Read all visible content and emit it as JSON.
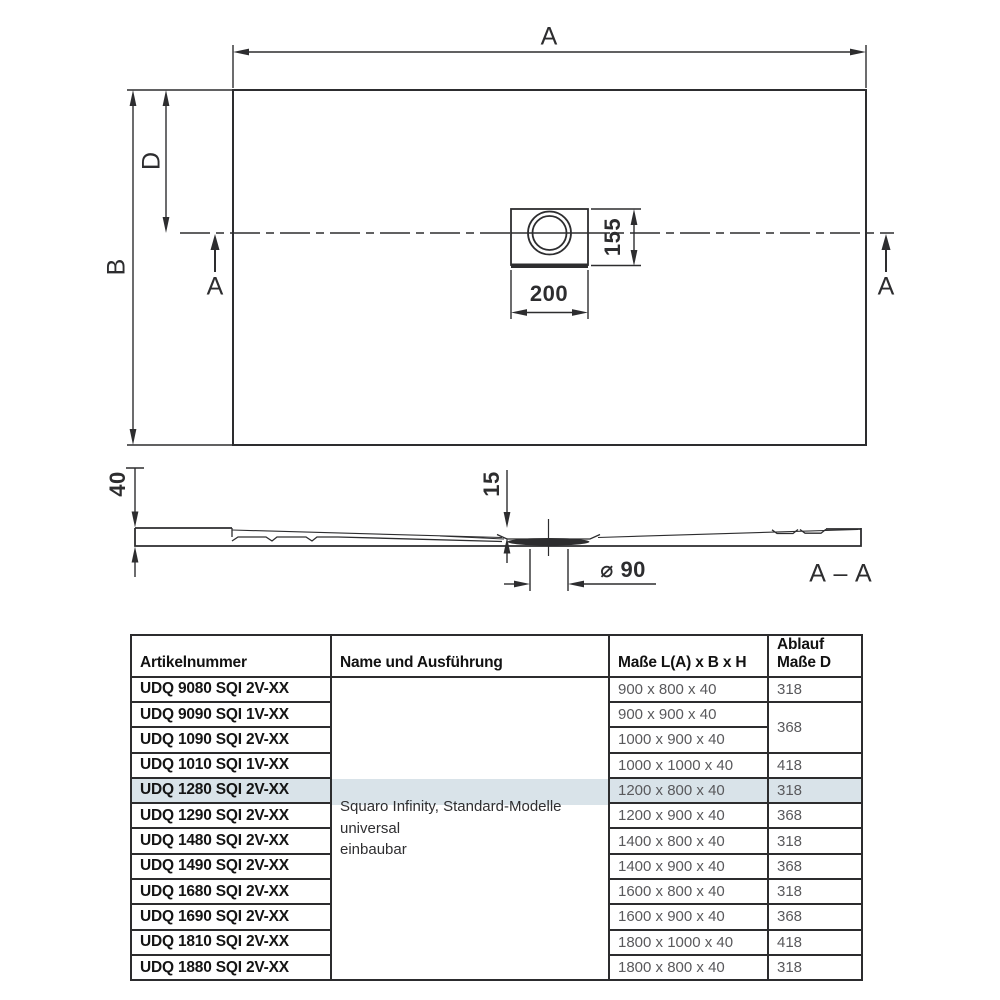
{
  "colors": {
    "line": "#2d2d2f",
    "highlight": "#d9e3e9",
    "value_text": "#59595c"
  },
  "top_view": {
    "overall_width_label": "A",
    "overall_depth_label": "B",
    "drain_center_offset_label": "D",
    "section_cut_left_label": "A",
    "section_cut_right_label": "A",
    "drain_unit_width_label": "200",
    "drain_unit_depth_label": "155"
  },
  "section_view": {
    "tray_height_label": "40",
    "inner_depth_label": "15",
    "drain_diameter_label": "⌀ 90",
    "section_title_label": "A – A"
  },
  "table": {
    "header": {
      "artikelnummer": "Artikelnummer",
      "name_und_ausfuehrung": "Name und Ausführung",
      "masse": "Maße L(A) x B x H",
      "ablauf_line1": "Ablauf",
      "ablauf_line2": "Maße D"
    },
    "name_lines": [
      "Squaro Infinity, Standard-Modelle universal",
      "einbaubar"
    ],
    "highlighted_row_index": 4,
    "rows": [
      {
        "art": "UDQ 9080 SQI 2V-XX",
        "masse": "900 x 800 x 40",
        "ablauf": "318"
      },
      {
        "art": "UDQ 9090 SQI 1V-XX",
        "masse": "900 x 900 x 40",
        "ablauf": "368"
      },
      {
        "art": "UDQ 1090 SQI 2V-XX",
        "masse": "1000 x 900 x 40"
      },
      {
        "art": "UDQ 1010 SQI 1V-XX",
        "masse": "1000 x 1000 x 40",
        "ablauf": "418"
      },
      {
        "art": "UDQ 1280 SQI 2V-XX",
        "masse": "1200 x 800 x 40",
        "ablauf": "318"
      },
      {
        "art": "UDQ 1290 SQI 2V-XX",
        "masse": "1200 x 900 x 40",
        "ablauf": "368"
      },
      {
        "art": "UDQ 1480 SQI 2V-XX",
        "masse": "1400 x 800 x 40",
        "ablauf": "318"
      },
      {
        "art": "UDQ 1490 SQI 2V-XX",
        "masse": "1400 x 900 x 40",
        "ablauf": "368"
      },
      {
        "art": "UDQ 1680 SQI 2V-XX",
        "masse": "1600 x 800 x 40",
        "ablauf": "318"
      },
      {
        "art": "UDQ 1690 SQI 2V-XX",
        "masse": "1600 x 900 x 40",
        "ablauf": "368"
      },
      {
        "art": "UDQ 1810 SQI 2V-XX",
        "masse": "1800 x 1000 x 40",
        "ablauf": "418"
      },
      {
        "art": "UDQ 1880 SQI 2V-XX",
        "masse": "1800 x 800 x 40",
        "ablauf": "318"
      }
    ]
  }
}
